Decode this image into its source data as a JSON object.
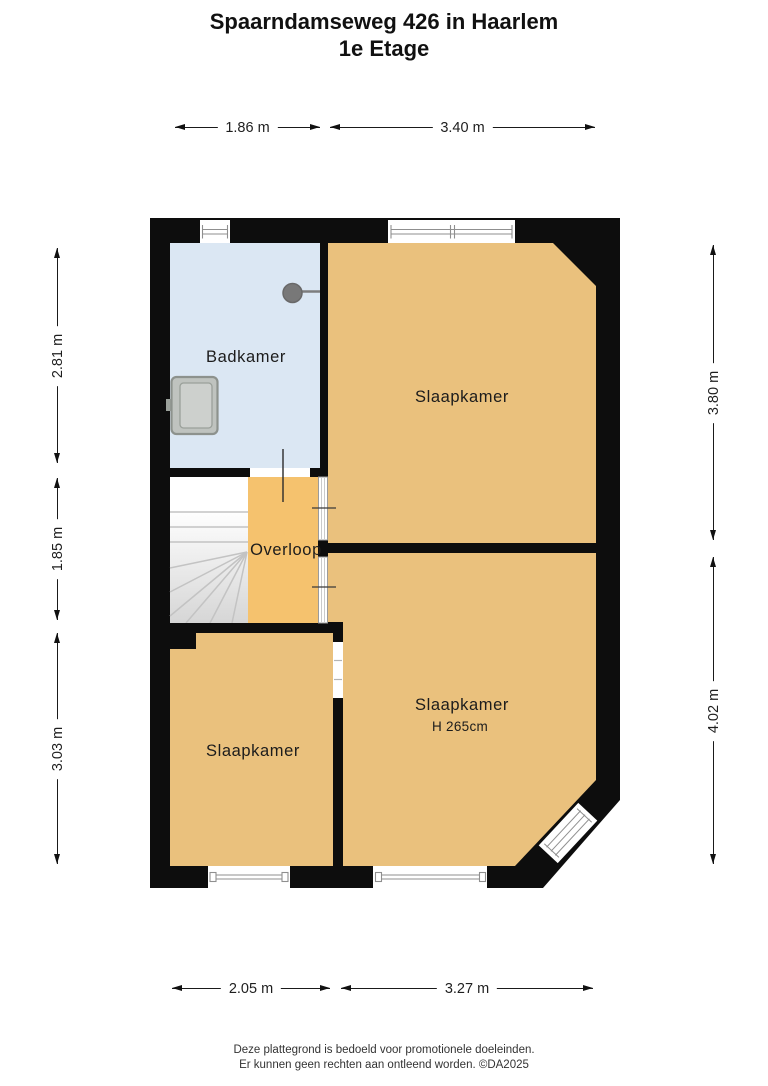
{
  "title": {
    "line1": "Spaarndamseweg 426 in Haarlem",
    "line2": "1e Etage"
  },
  "rooms": {
    "badkamer": {
      "label": "Badkamer"
    },
    "slaapkamer_top": {
      "label": "Slaapkamer"
    },
    "overloop": {
      "label": "Overloop"
    },
    "slaapkamer_right": {
      "label": "Slaapkamer",
      "height": "H 265cm"
    },
    "slaapkamer_left": {
      "label": "Slaapkamer"
    }
  },
  "dimensions": {
    "top": [
      "1.86 m",
      "3.40 m"
    ],
    "bottom": [
      "2.05 m",
      "3.27 m"
    ],
    "left": [
      "2.81 m",
      "1.85 m",
      "3.03 m"
    ],
    "right": [
      "3.80 m",
      "4.02 m"
    ]
  },
  "footer": {
    "line1": "Deze plattegrond is bedoeld voor promotionele doeleinden.",
    "line2": "Er kunnen geen rechten aan ontleend worden. ©DA2025"
  },
  "colors": {
    "wall": "#0d0d0d",
    "bedroom": "#eac17d",
    "bathroom": "#dbe7f3",
    "landing": "#f5c26e",
    "window_line": "#8f8f8f",
    "stair_line": "#c3c3c3"
  }
}
